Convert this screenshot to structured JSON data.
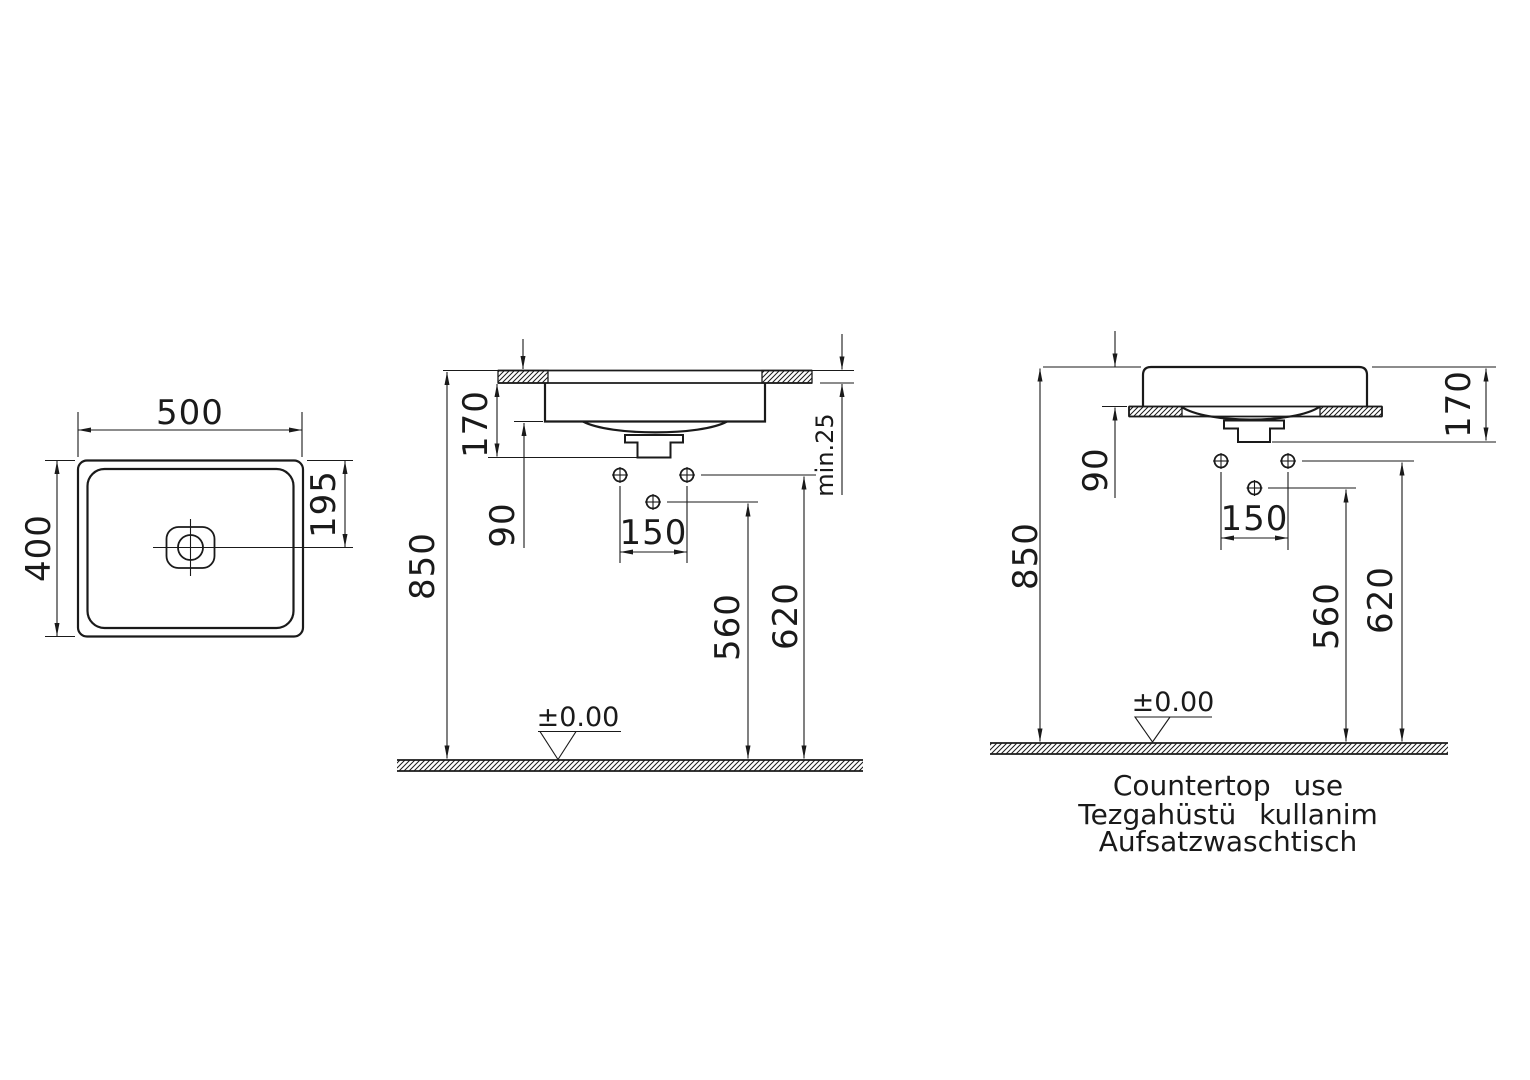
{
  "page": {
    "background": "#ffffff",
    "line_color": "#1a1a1a"
  },
  "views": {
    "top_view": {
      "width": "500",
      "depth": "400",
      "drain_offset": "195"
    },
    "semi_recessed_view": {
      "basin_height": "170",
      "below_counter": "90",
      "counter_height": "850",
      "tap_hole_spacing": "150",
      "middle_hole_height": "560",
      "side_holes_height": "620",
      "counter_thickness": "min.25",
      "datum": "±0.00"
    },
    "countertop_view": {
      "basin_height": "170",
      "above_counter": "90",
      "rim_height": "850",
      "tap_hole_spacing": "150",
      "middle_hole_height": "560",
      "side_holes_height": "620",
      "datum": "±0.00",
      "captions": [
        "Countertop use",
        "Tezgahüstü kullanim",
        "Aufsatzwaschtisch"
      ]
    }
  }
}
